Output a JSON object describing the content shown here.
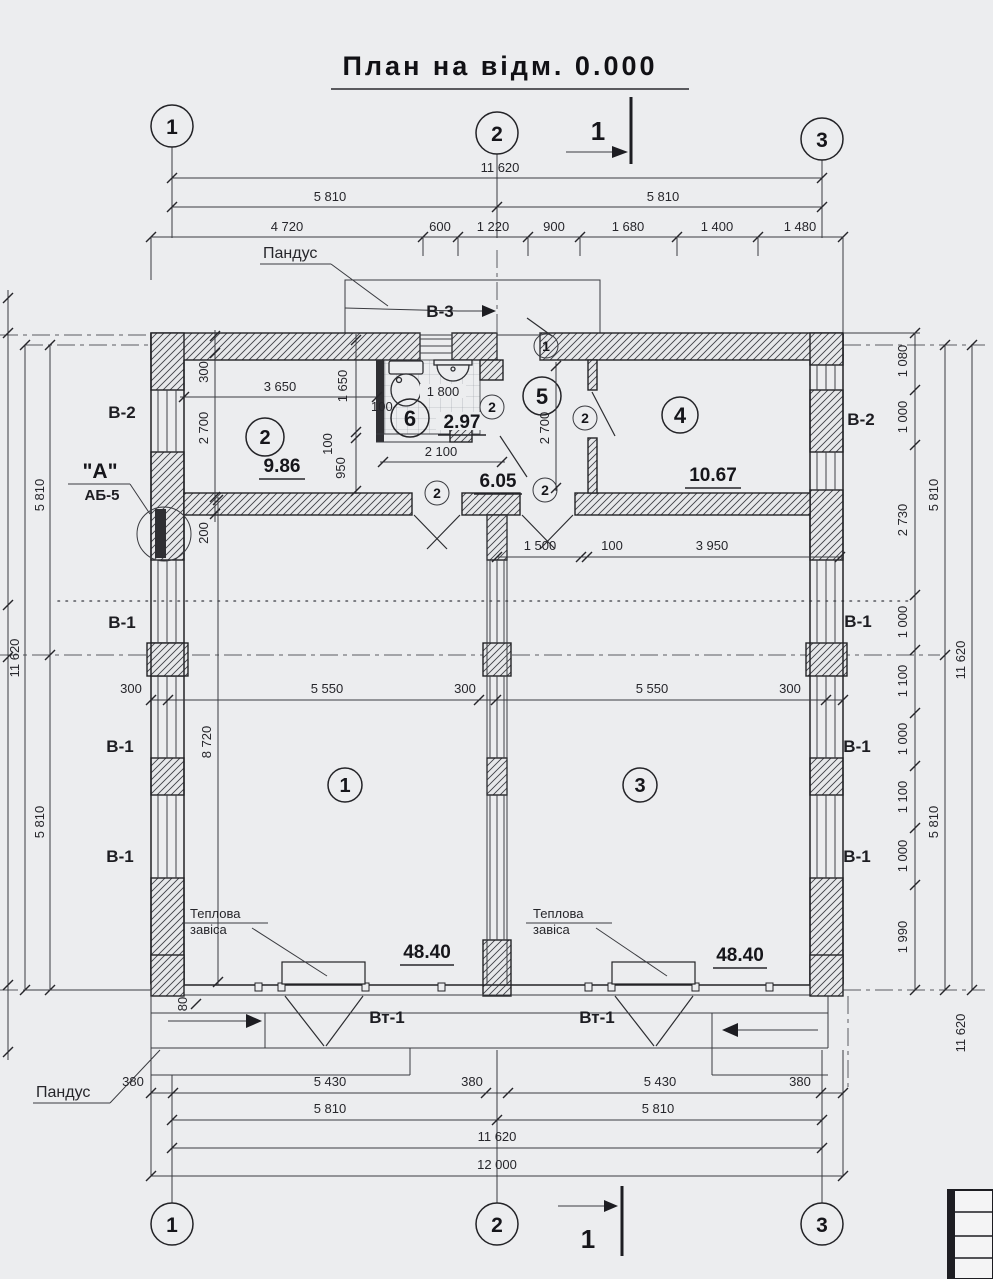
{
  "title": "План на відм. 0.000",
  "axes": {
    "n1": "1",
    "n2": "2",
    "n3": "3"
  },
  "section": {
    "label": "1"
  },
  "labels": {
    "pandus": "Пандус",
    "v1": "В-1",
    "v2": "В-2",
    "v3": "В-3",
    "vt1": "Вт-1",
    "mark_a": "\"А\"",
    "ab5": "АБ-5",
    "heat1": "Теплова",
    "heat2": "завіса"
  },
  "rooms": {
    "r1": {
      "num": "1",
      "area": "48.40"
    },
    "r2": {
      "num": "2",
      "area": "9.86"
    },
    "r3": {
      "num": "3",
      "area": "48.40"
    },
    "r4": {
      "num": "4",
      "area": "10.67"
    },
    "r5": {
      "num": "5",
      "area": "6.05"
    },
    "r6": {
      "num": "6",
      "area": "2.97"
    }
  },
  "door_marks": {
    "m1": "1",
    "m2": "2"
  },
  "dims": {
    "top": {
      "total": "11 620",
      "half_left": "5 810",
      "half_right": "5 810",
      "segments": [
        "4 720",
        "600",
        "1 220",
        "900",
        "1 680",
        "1 400",
        "1 480"
      ]
    },
    "bottom": {
      "segments": [
        "380",
        "5 430",
        "380",
        "5 430",
        "380"
      ],
      "half_left": "5 810",
      "half_right": "5 810",
      "total": "11 620",
      "overall": "12 000"
    },
    "left": {
      "half_top": "5 810",
      "half_bottom": "5 810",
      "total": "11 620"
    },
    "right": {
      "segments": [
        "1 080",
        "1 000",
        "2 730",
        "1 000",
        "1 100",
        "1 000",
        "1 100",
        "1 000",
        "1 990"
      ],
      "half_top": "5 810",
      "half_bottom": "5 810",
      "total": "11 620",
      "total_b": "11 620"
    },
    "interior": {
      "wall300": "300",
      "w3650": "3 650",
      "h2700": "2 700",
      "h200": "200",
      "h1650": "1 650",
      "t100a": "100",
      "t100b": "100",
      "h950": "950",
      "w1800": "1 800",
      "w2100": "2 100",
      "h2700b": "2 700",
      "w1500": "1 500",
      "t100c": "100",
      "w3950": "3 950",
      "mid_row": [
        "300",
        "5 550",
        "300",
        "5 550",
        "300"
      ],
      "h8720": "8 720",
      "h80": "80"
    }
  }
}
